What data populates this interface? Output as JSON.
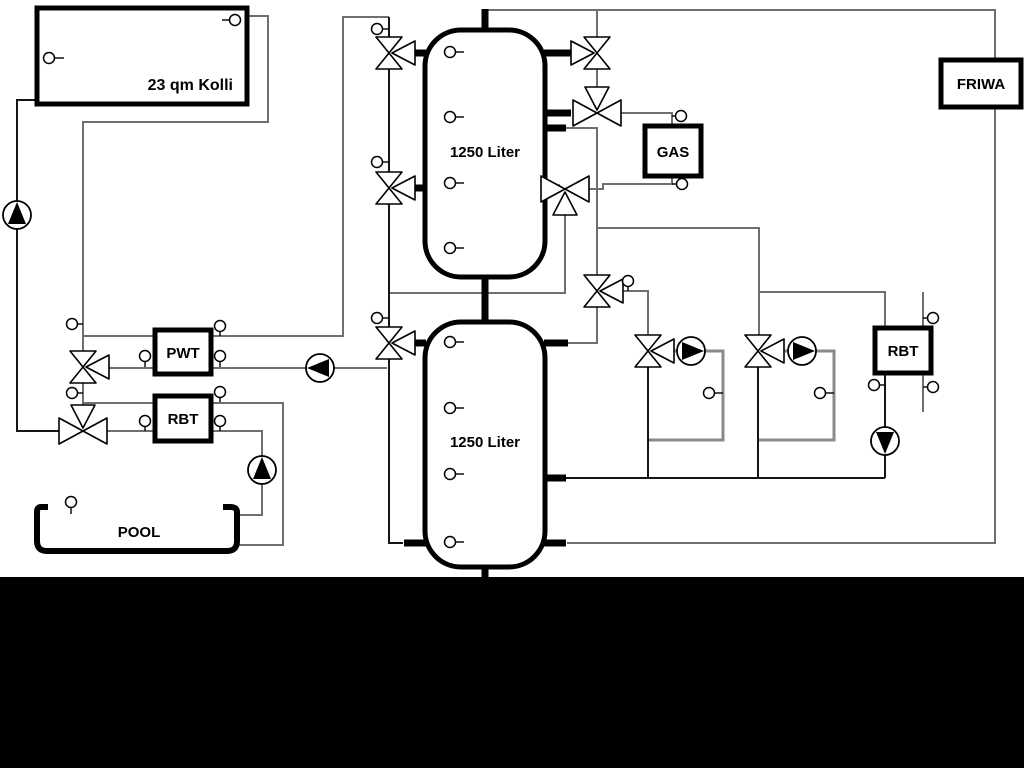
{
  "labels": {
    "collector": "23 qm Kolli",
    "tank1": "1250 Liter",
    "tank2": "1250 Liter",
    "pwt": "PWT",
    "rbt_left": "RBT",
    "gas": "GAS",
    "friwa": "FRIWA",
    "rbt_right": "RBT",
    "pool": "POOL"
  },
  "colors": {
    "pipe_gray": "#6f6f6f",
    "pipe_dark": "#161616",
    "symbol_outline": "#000000",
    "background": "#ffffff",
    "bottom_bar": "#000000"
  }
}
